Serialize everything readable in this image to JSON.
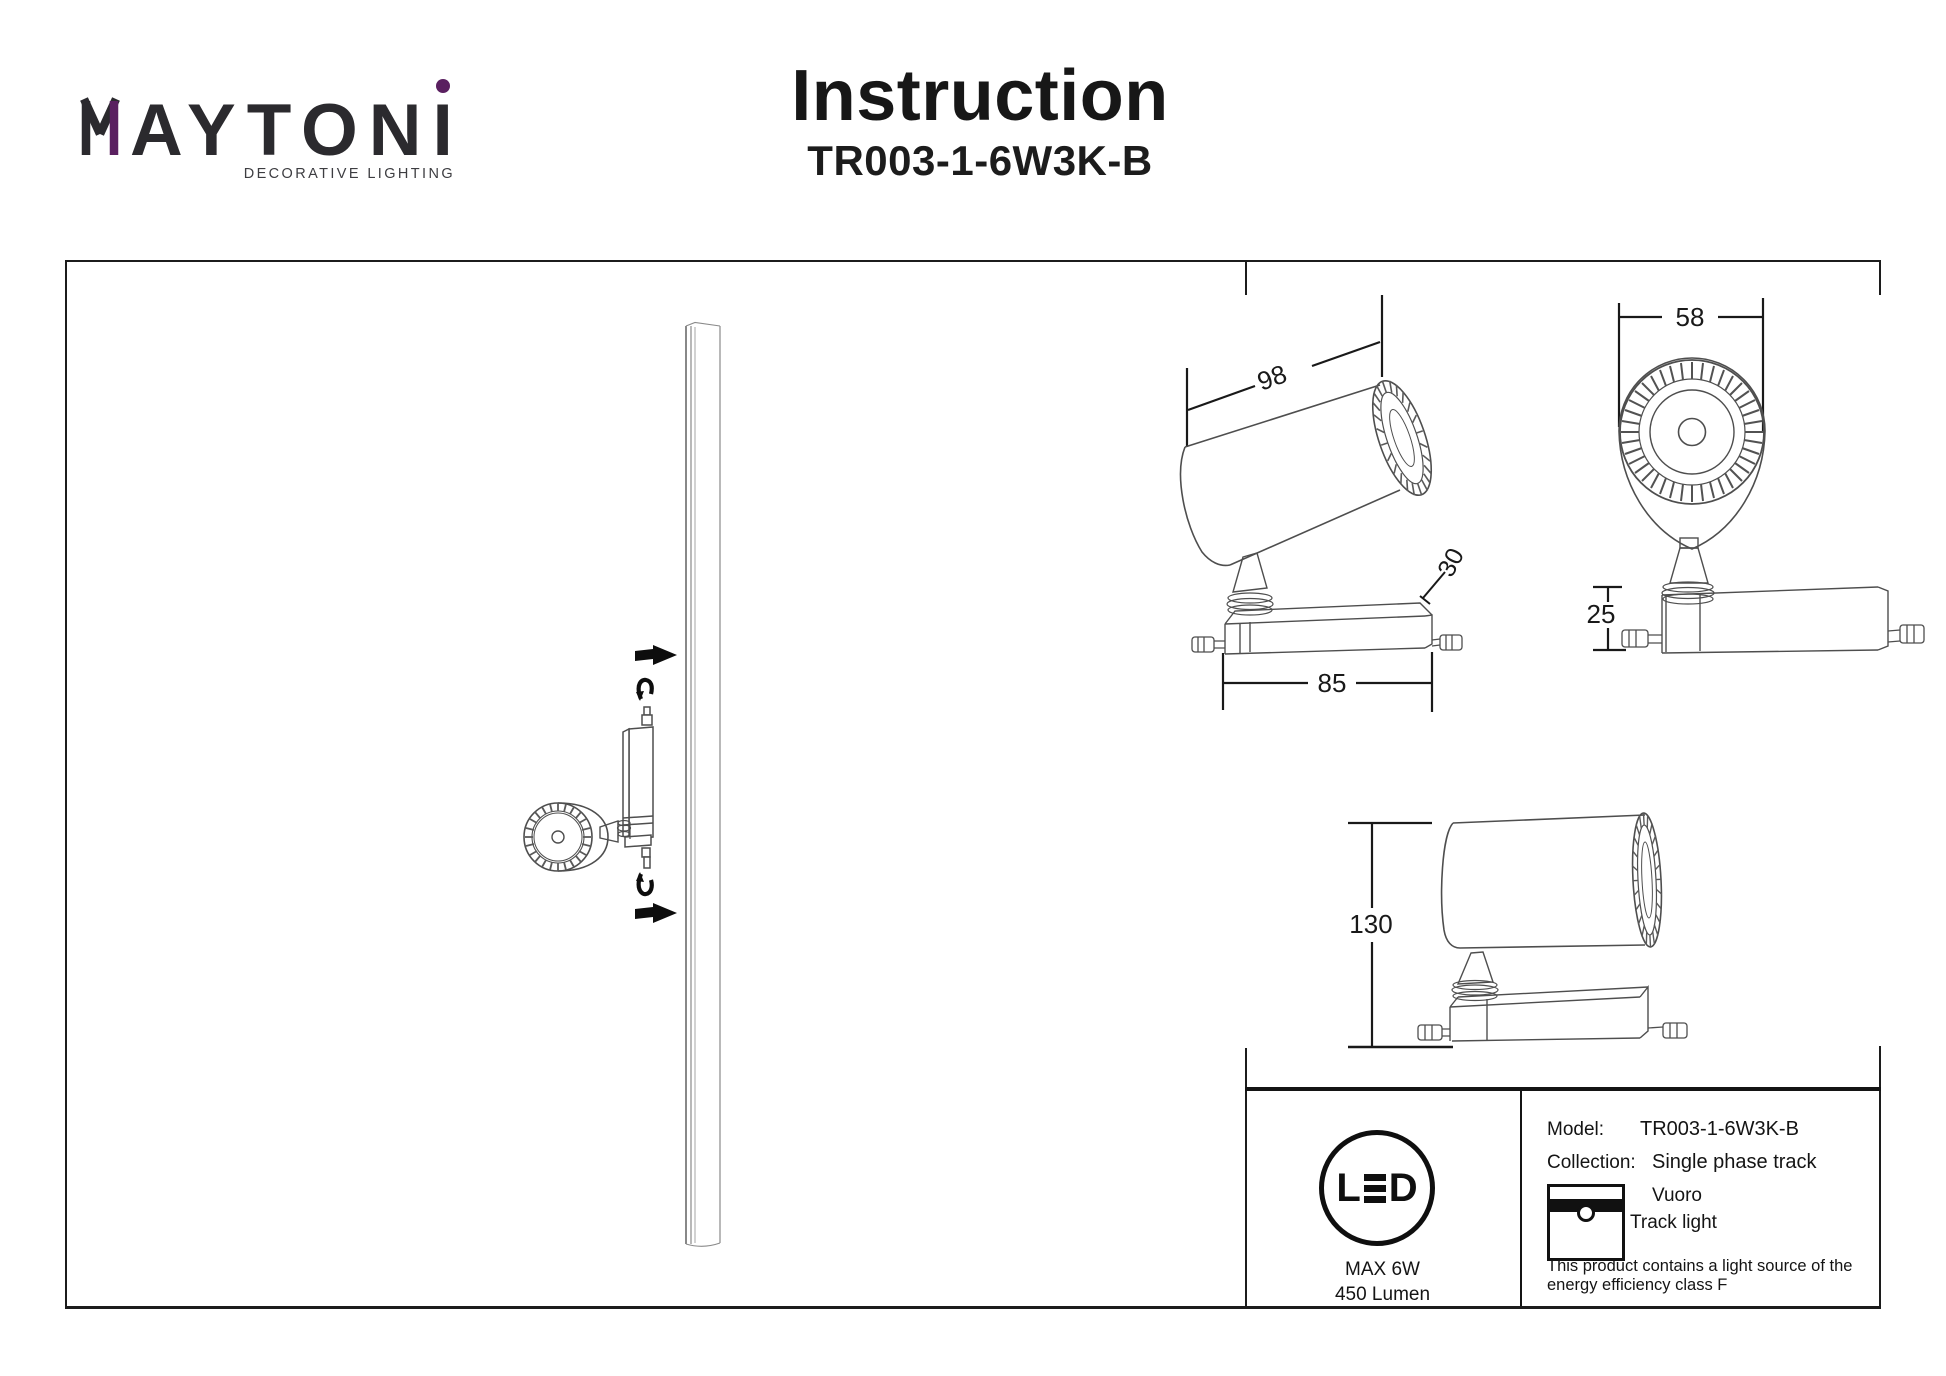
{
  "brand": {
    "wordmark_m": "M",
    "wordmark_rest": "AYTONI",
    "tagline": "DECORATIVE LIGHTING",
    "purple_accent": "#5a2060",
    "ink": "#2b2a2e"
  },
  "header": {
    "title": "Instruction",
    "model": "TR003-1-6W3K-B"
  },
  "drawings": {
    "side_view": {
      "length": "98",
      "angle": "30",
      "base_width": "85"
    },
    "front_view": {
      "width": "58",
      "base_height": "25"
    },
    "height_view": {
      "height": "130"
    }
  },
  "info_panel": {
    "led_badge": {
      "label_l": "L",
      "label_d": "D",
      "max_power": "MAX 6W",
      "luminous_flux": "450 Lumen"
    },
    "model_label": "Model:",
    "model_value": "TR003-1-6W3K-B",
    "collection_label": "Collection:",
    "collection_value": "Single phase track",
    "series_name": "Vuoro",
    "product_type": "Track light",
    "note_line1": "This product contains a light source of the",
    "note_line2": "energy efficiency class F"
  }
}
